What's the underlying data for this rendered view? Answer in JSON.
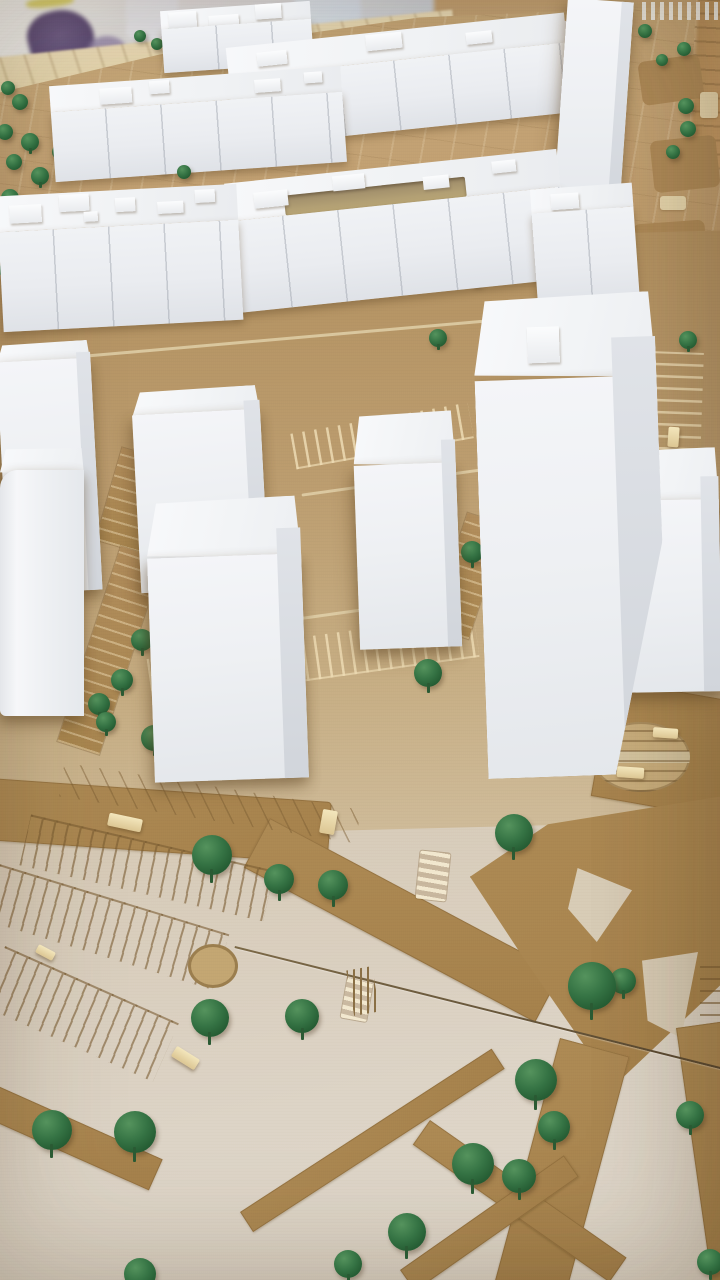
{
  "scene": {
    "label": "Architectural cardboard city model with white massing buildings and green model trees",
    "colors": {
      "building_white": "#eff1f4",
      "building_shadow": "#d1d5db",
      "tree_green": "#2d6a3c",
      "cardboard_road_tan": "#a8854f",
      "upper_lot_tan": "#c2a173",
      "board_beige": "#dcd2c2",
      "background_purple": "#5d4c77",
      "background_yellow": "#dcd36f",
      "car_block_beige": "#e9d9ae"
    },
    "slabs": [
      {
        "x": 162,
        "y": 6,
        "w": 150,
        "h": 62,
        "topH": 18,
        "rot": -4,
        "boxes": [
          [
            8,
            2,
            28,
            16
          ],
          [
            48,
            8,
            30,
            14
          ],
          [
            95,
            0,
            26,
            15
          ],
          [
            20,
            26,
            24,
            13
          ],
          [
            70,
            30,
            28,
            14
          ],
          [
            112,
            28,
            22,
            12
          ]
        ]
      },
      {
        "x": 445,
        "y": 24,
        "w": 125,
        "h": 80,
        "topH": 26,
        "rot": -3,
        "slot": [
          18,
          4,
          88,
          20
        ],
        "boxes": [
          [
            4,
            8,
            18,
            12
          ]
        ]
      },
      {
        "x": 230,
        "y": 30,
        "w": 340,
        "h": 100,
        "topH": 30,
        "rot": -6,
        "boxes": [
          [
            30,
            8,
            30,
            14
          ],
          [
            140,
            2,
            36,
            16
          ],
          [
            240,
            10,
            26,
            12
          ]
        ]
      },
      {
        "x": 52,
        "y": 76,
        "w": 292,
        "h": 96,
        "topH": 26,
        "rot": -4,
        "boxes": [
          [
            50,
            6,
            32,
            16
          ],
          [
            100,
            2,
            20,
            13
          ],
          [
            205,
            8,
            26,
            13
          ],
          [
            255,
            4,
            18,
            11
          ]
        ]
      },
      {
        "x": 0,
        "y": 190,
        "w": 240,
        "h": 136,
        "topH": 36,
        "rot": -3,
        "boxes": [
          [
            12,
            10,
            32,
            18
          ],
          [
            62,
            2,
            30,
            17
          ],
          [
            118,
            8,
            20,
            14
          ],
          [
            160,
            14,
            26,
            12
          ],
          [
            198,
            4,
            20,
            13
          ],
          [
            86,
            20,
            14,
            10
          ]
        ]
      },
      {
        "x": 230,
        "y": 166,
        "w": 334,
        "h": 130,
        "topH": 38,
        "rot": -6,
        "slot": [
          58,
          18,
          182,
          20
        ],
        "boxes": [
          [
            28,
            12,
            34,
            16
          ],
          [
            108,
            4,
            32,
            15
          ],
          [
            198,
            14,
            26,
            13
          ],
          [
            268,
            6,
            24,
            12
          ]
        ]
      },
      {
        "x": 534,
        "y": 186,
        "w": 102,
        "h": 120,
        "topH": 24,
        "rot": -4,
        "boxes": [
          [
            20,
            6,
            28,
            16
          ]
        ]
      }
    ],
    "towers": [
      {
        "x": 560,
        "y": 0,
        "w": 66,
        "h": 225,
        "topH": 0,
        "rot": 4,
        "side": 12
      },
      {
        "x": 2,
        "y": 342,
        "w": 94,
        "h": 250,
        "topH": 24,
        "rot": -3,
        "side": 14
      },
      {
        "x": 136,
        "y": 388,
        "w": 128,
        "h": 202,
        "topH": 30,
        "rot": -3,
        "side": 16
      },
      {
        "x": 0,
        "y": 448,
        "w": 84,
        "h": 268,
        "topH": 28,
        "rot": 0,
        "side": 0,
        "rounded": true
      },
      {
        "x": 614,
        "y": 448,
        "w": 106,
        "h": 244,
        "topH": 58,
        "rot": -1,
        "side": 18
      },
      {
        "x": 356,
        "y": 412,
        "w": 102,
        "h": 236,
        "topH": 58,
        "rot": -2,
        "side": 14
      },
      {
        "x": 150,
        "y": 498,
        "w": 154,
        "h": 282,
        "topH": 64,
        "rot": -2,
        "side": 24
      },
      {
        "x": 480,
        "y": 294,
        "w": 182,
        "h": 482,
        "topH": 90,
        "rot": -2,
        "side": 44,
        "box": [
          54,
          32,
          32,
          36
        ],
        "clip": "polygon(0% 0%,100% 0%,100% 52%,70% 100%,0% 100%)"
      }
    ],
    "trees": [
      [
        140,
        36,
        6
      ],
      [
        157,
        44,
        6
      ],
      [
        174,
        30,
        6
      ],
      [
        188,
        46,
        6
      ],
      [
        346,
        90,
        7
      ],
      [
        645,
        31,
        7
      ],
      [
        662,
        60,
        6
      ],
      [
        684,
        49,
        7
      ],
      [
        686,
        106,
        8
      ],
      [
        688,
        129,
        8
      ],
      [
        673,
        152,
        7
      ],
      [
        588,
        165,
        7
      ],
      [
        8,
        88,
        7
      ],
      [
        20,
        102,
        8
      ],
      [
        5,
        132,
        8
      ],
      [
        30,
        142,
        9
      ],
      [
        14,
        162,
        8
      ],
      [
        40,
        176,
        9
      ],
      [
        10,
        198,
        9
      ],
      [
        36,
        208,
        9
      ],
      [
        60,
        152,
        8
      ],
      [
        72,
        95,
        7
      ],
      [
        86,
        120,
        8
      ],
      [
        15,
        222,
        9
      ],
      [
        25,
        242,
        10
      ],
      [
        8,
        270,
        9
      ],
      [
        30,
        288,
        10
      ],
      [
        120,
        150,
        7
      ],
      [
        142,
        158,
        7
      ],
      [
        163,
        166,
        7
      ],
      [
        184,
        172,
        7
      ],
      [
        232,
        161,
        6
      ],
      [
        372,
        186,
        7
      ],
      [
        396,
        199,
        7
      ],
      [
        421,
        196,
        7
      ],
      [
        446,
        206,
        7
      ],
      [
        470,
        213,
        7
      ],
      [
        462,
        258,
        8
      ],
      [
        476,
        278,
        8
      ],
      [
        508,
        310,
        8
      ],
      [
        438,
        338,
        9
      ],
      [
        499,
        356,
        9
      ],
      [
        497,
        396,
        10
      ],
      [
        688,
        340,
        9
      ],
      [
        150,
        566,
        10
      ],
      [
        172,
        578,
        10
      ],
      [
        142,
        640,
        11
      ],
      [
        122,
        680,
        11
      ],
      [
        99,
        704,
        11
      ],
      [
        106,
        722,
        10
      ],
      [
        154,
        738,
        13
      ],
      [
        472,
        552,
        11
      ],
      [
        592,
        660,
        14
      ],
      [
        428,
        673,
        14
      ],
      [
        212,
        855,
        20
      ],
      [
        279,
        879,
        15
      ],
      [
        333,
        885,
        15
      ],
      [
        514,
        833,
        19
      ],
      [
        210,
        1018,
        19
      ],
      [
        302,
        1016,
        17
      ],
      [
        52,
        1130,
        20
      ],
      [
        135,
        1132,
        21
      ],
      [
        592,
        986,
        24
      ],
      [
        623,
        981,
        13
      ],
      [
        536,
        1080,
        21
      ],
      [
        554,
        1127,
        16
      ],
      [
        690,
        1115,
        14
      ],
      [
        473,
        1164,
        21
      ],
      [
        519,
        1176,
        17
      ],
      [
        407,
        1232,
        19
      ],
      [
        710,
        1262,
        13
      ],
      [
        140,
        1274,
        16
      ],
      [
        348,
        1264,
        14
      ]
    ],
    "cars": [
      [
        108,
        816,
        34,
        13,
        12
      ],
      [
        321,
        810,
        15,
        24,
        10
      ],
      [
        36,
        948,
        19,
        9,
        28
      ],
      [
        172,
        1052,
        27,
        12,
        32
      ],
      [
        653,
        728,
        25,
        10,
        4
      ],
      [
        617,
        767,
        27,
        11,
        4
      ],
      [
        668,
        427,
        11,
        20,
        4
      ],
      [
        700,
        640,
        11,
        18,
        6
      ]
    ]
  }
}
